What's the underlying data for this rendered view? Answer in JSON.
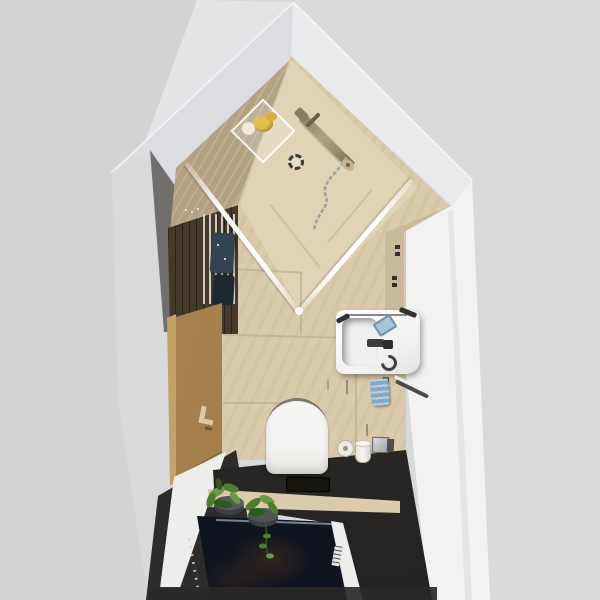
{
  "scene": {
    "type": "3d-interior-render-top-view",
    "room": "narrow bathroom floor plan, bird's-eye perspective",
    "objects": [
      "walk-in corner shower with glass enclosure",
      "shower column with hand shower and hose",
      "round floor drain",
      "glass shelf with yellow and white toiletries",
      "dark wood slat wall with towel ladder and navy towels",
      "wooden entry door with handle",
      "wall-hung white toilet",
      "toilet paper roll, brush cup and chrome plate",
      "white wash basin with faucet, blue soap tray and ring",
      "hanging blue towel and towel bar",
      "two potted green plants",
      "dark navy floor mat",
      "beige tiled floor and walls",
      "dark charcoal lower floor area"
    ]
  },
  "palette": {
    "bg": "#d8d9d9",
    "bgLeft": "#d2d3d3",
    "bgSliver": "#e3e4e6",
    "bandLeft": "#dcdde0",
    "bandRight": "#e9eaeb",
    "wallWhite": "#f1f2f1",
    "wallFaceGray": "#d8d9da",
    "wallShadowStrip": "#5e5c59",
    "wood": "#b3a182",
    "beigeFloor": "#d9cbab",
    "beigeShower": "#e0d4b6",
    "tanStrip": "#c9ba9b",
    "seam": "#b6a888",
    "darkWood": "#45392a",
    "ladderWhite": "#e9e7e2",
    "towelNavy1": "#33434f",
    "towelNavy2": "#1e2832",
    "door": "#a5804c",
    "doorFrame": "#c5a069",
    "doorHandle": "#dcc9a4",
    "charcoal": "#2d2c2a",
    "bottomStrip": "#2a2927",
    "navy": "#10141f",
    "navyLine": "#8b95a5",
    "sparkle": "#cdd3d8",
    "rimWhite": "#edeeec",
    "sinkWhite": "#f6f5f3",
    "blueItem": "#a6c4da",
    "towelBlue": "#84a8c4",
    "darkAccent": "#31312f",
    "chrome": "#a3a3a1",
    "yellow": "#e2c14b",
    "cream": "#efe9d8",
    "drainDark": "#3a3a38",
    "potDark": "#3c4043",
    "leaf1": "#6a9b44",
    "leaf2": "#4e7c31",
    "leaf3": "#2f5a1e"
  }
}
